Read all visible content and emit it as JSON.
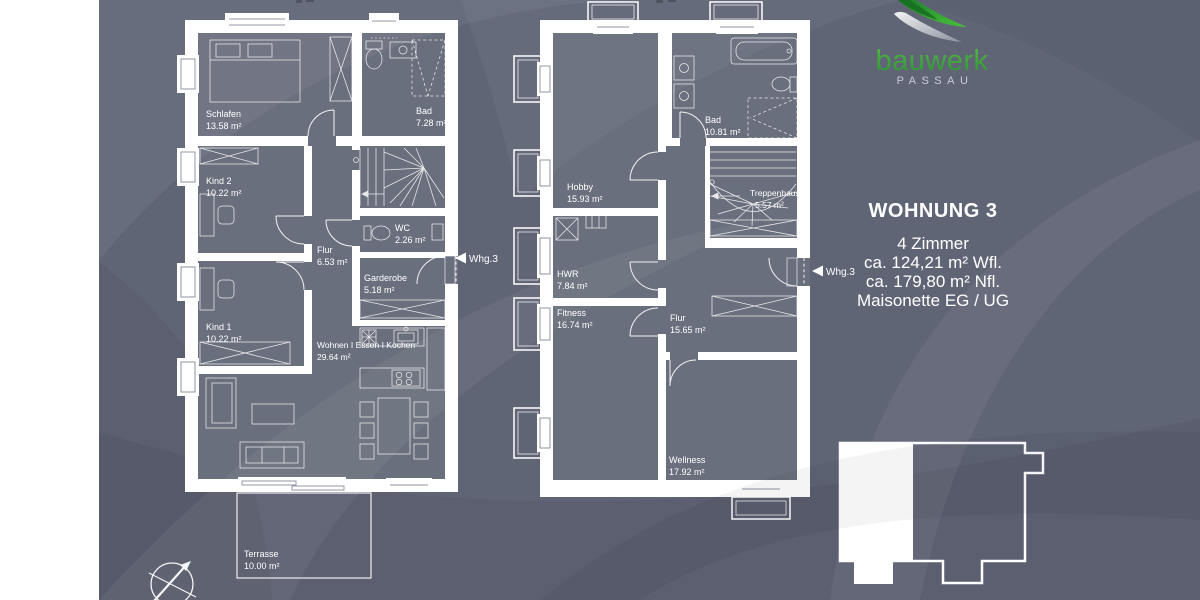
{
  "colors": {
    "background": "#606576",
    "room_fill": "#6a6f7d",
    "wall": "#ffffff",
    "brand_green": "#3aa33c",
    "brand_silver": "#c7cbd4"
  },
  "branding": {
    "name": "bauwerk",
    "city": "PASSAU"
  },
  "info_panel": {
    "title": "WOHNUNG 3",
    "details": [
      "4 Zimmer",
      "ca. 124,21 m² Wfl.",
      "ca. 179,80 m² Nfl.",
      "Maisonette EG / UG"
    ]
  },
  "floorplans": {
    "eg": {
      "entry_marker": "Whg.3",
      "rooms": [
        {
          "name": "Schlafen",
          "area": "13.58 m²"
        },
        {
          "name": "Bad",
          "area": "7.28 m²"
        },
        {
          "name": "Kind 2",
          "area": "10.22 m²"
        },
        {
          "name": "Flur",
          "area": "6.53 m²"
        },
        {
          "name": "WC",
          "area": "2.26 m²"
        },
        {
          "name": "Garderobe",
          "area": "5.18 m²"
        },
        {
          "name": "Kind 1",
          "area": "10.22 m²"
        },
        {
          "name": "Wohnen I Essen I Kochen",
          "area": "29.64 m²"
        },
        {
          "name": "Terrasse",
          "area": "10.00 m²"
        }
      ]
    },
    "ug": {
      "entry_marker": "Whg.3",
      "rooms": [
        {
          "name": "Hobby",
          "area": "15.93 m²"
        },
        {
          "name": "Bad",
          "area": "10.81 m²"
        },
        {
          "name": "Treppenhaus",
          "area": "5.57 m²"
        },
        {
          "name": "HWR",
          "area": "7.84 m²"
        },
        {
          "name": "Fitness",
          "area": "16.74 m²"
        },
        {
          "name": "Flur",
          "area": "15.65 m²"
        },
        {
          "name": "Wellness",
          "area": "17.92 m²"
        }
      ]
    }
  }
}
